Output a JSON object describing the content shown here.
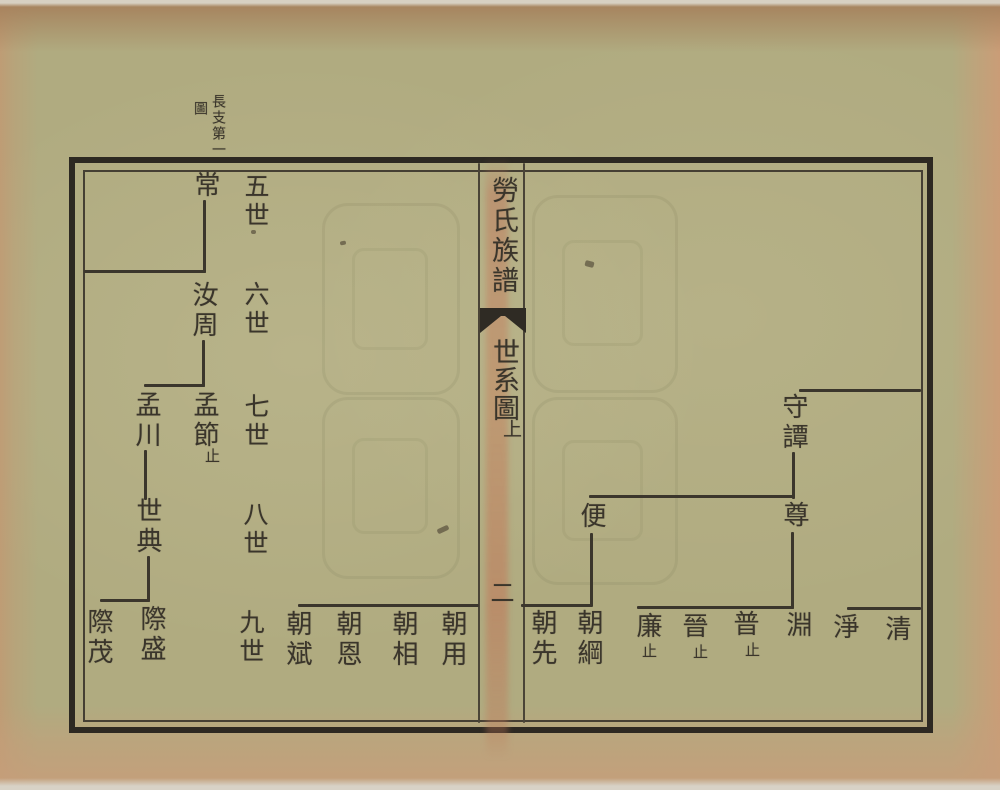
{
  "margin_label": {
    "column_right": "長支第一",
    "column_left": "圖"
  },
  "gutter": {
    "book_title": "勞氏族譜",
    "section_title": "世系圖",
    "part_label": "上",
    "page_number": "二"
  },
  "generation_labels": [
    "五世",
    "六世",
    "七世",
    "八世",
    "九世"
  ],
  "names": {
    "chang": "常",
    "ruzhou": "汝周",
    "mengjie": "孟節",
    "mengchuan": "孟川",
    "shidian": "世典",
    "jisheng": "際盛",
    "jimao": "際茂",
    "chaobin": "朝斌",
    "chaoen": "朝恩",
    "chaoxiang": "朝相",
    "chaoyong": "朝用",
    "shoutan": "守譚",
    "zun": "尊",
    "bian": "便",
    "chaoxian": "朝先",
    "chaogang": "朝綱",
    "lian": "廉",
    "jin": "晉",
    "pu": "普",
    "yuan": "淵",
    "jing": "淨",
    "qing": "清"
  },
  "annotations": {
    "stop": "止"
  },
  "colors": {
    "paper": "#b0ab80",
    "ink": "#3a352b",
    "frame_border": "#2d2922",
    "fold_stain": "#c17a5e",
    "edge_tint": "#c49b7d"
  }
}
